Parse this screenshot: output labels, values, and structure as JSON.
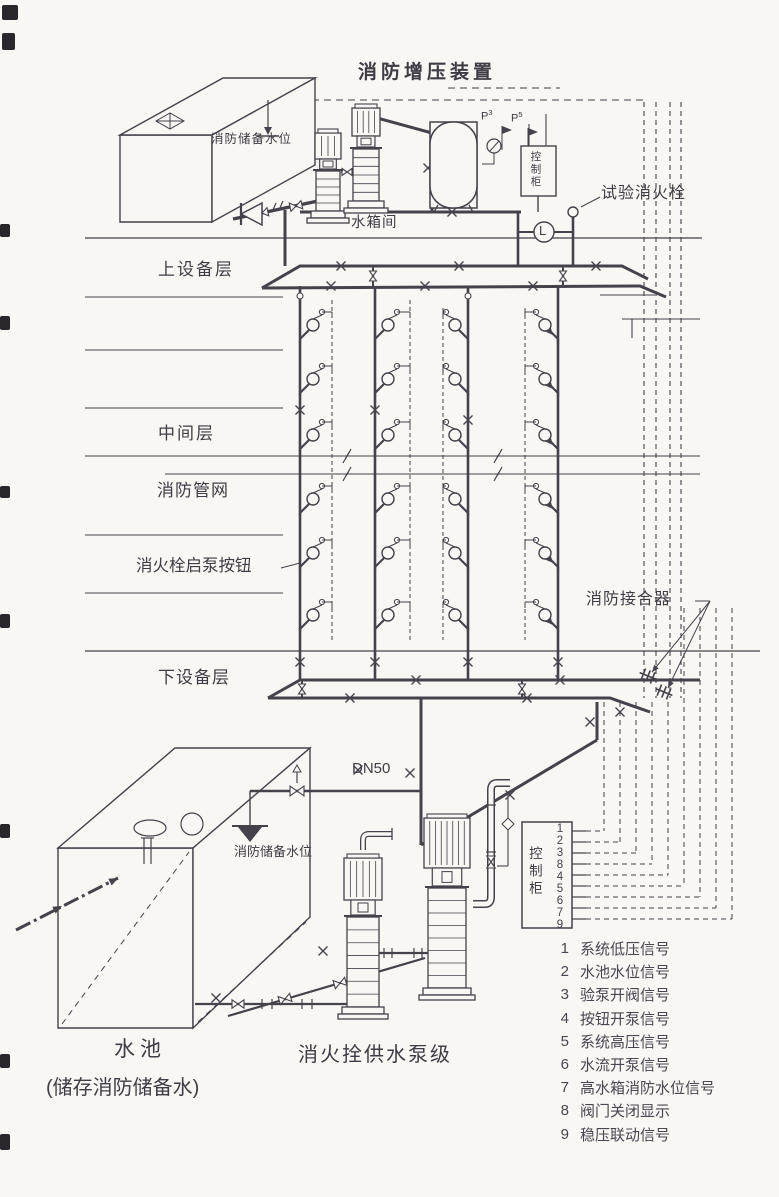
{
  "diagram": {
    "title": "消防增压装置",
    "labels": {
      "upper_tank_level": "消防储备水位",
      "tank_room": "水箱间",
      "test_hydrant": "试验消火栓",
      "upper_equipment_floor": "上设备层",
      "middle_floor": "中间层",
      "fire_pipe_network": "消防管网",
      "hydrant_pump_button": "消火栓启泵按钮",
      "siamese_connection": "消防接合器",
      "lower_equipment_floor": "下设备层",
      "pipe_size": "DN50",
      "pool_reserve_level": "消防储备水位",
      "pool": "水池",
      "pool_note": "(储存消防储备水)",
      "pump_group": "消火拴供水泵级",
      "control_cabinet_top": "控制柜",
      "control_cabinet_bottom": "控制柜",
      "flow_indicator": "L",
      "gauge_letter": "P",
      "gauge_sup_3": "3",
      "gauge_sup_5": "5"
    },
    "cabinet": {
      "terminals": [
        "1",
        "2",
        "3",
        "8",
        "4",
        "5",
        "6",
        "7",
        "9"
      ]
    },
    "legend": {
      "items": [
        {
          "num": "1",
          "text": "系统低压信号"
        },
        {
          "num": "2",
          "text": "水池水位信号"
        },
        {
          "num": "3",
          "text": "验泵开阀信号"
        },
        {
          "num": "4",
          "text": "按钮开泵信号"
        },
        {
          "num": "5",
          "text": "系统高压信号"
        },
        {
          "num": "6",
          "text": "水流开泵信号"
        },
        {
          "num": "7",
          "text": "高水箱消防水位信号"
        },
        {
          "num": "8",
          "text": "阀门关闭显示"
        },
        {
          "num": "9",
          "text": "稳压联动信号"
        }
      ]
    },
    "colors": {
      "ink": "#46414b",
      "paper": "#f8f7f4"
    }
  }
}
